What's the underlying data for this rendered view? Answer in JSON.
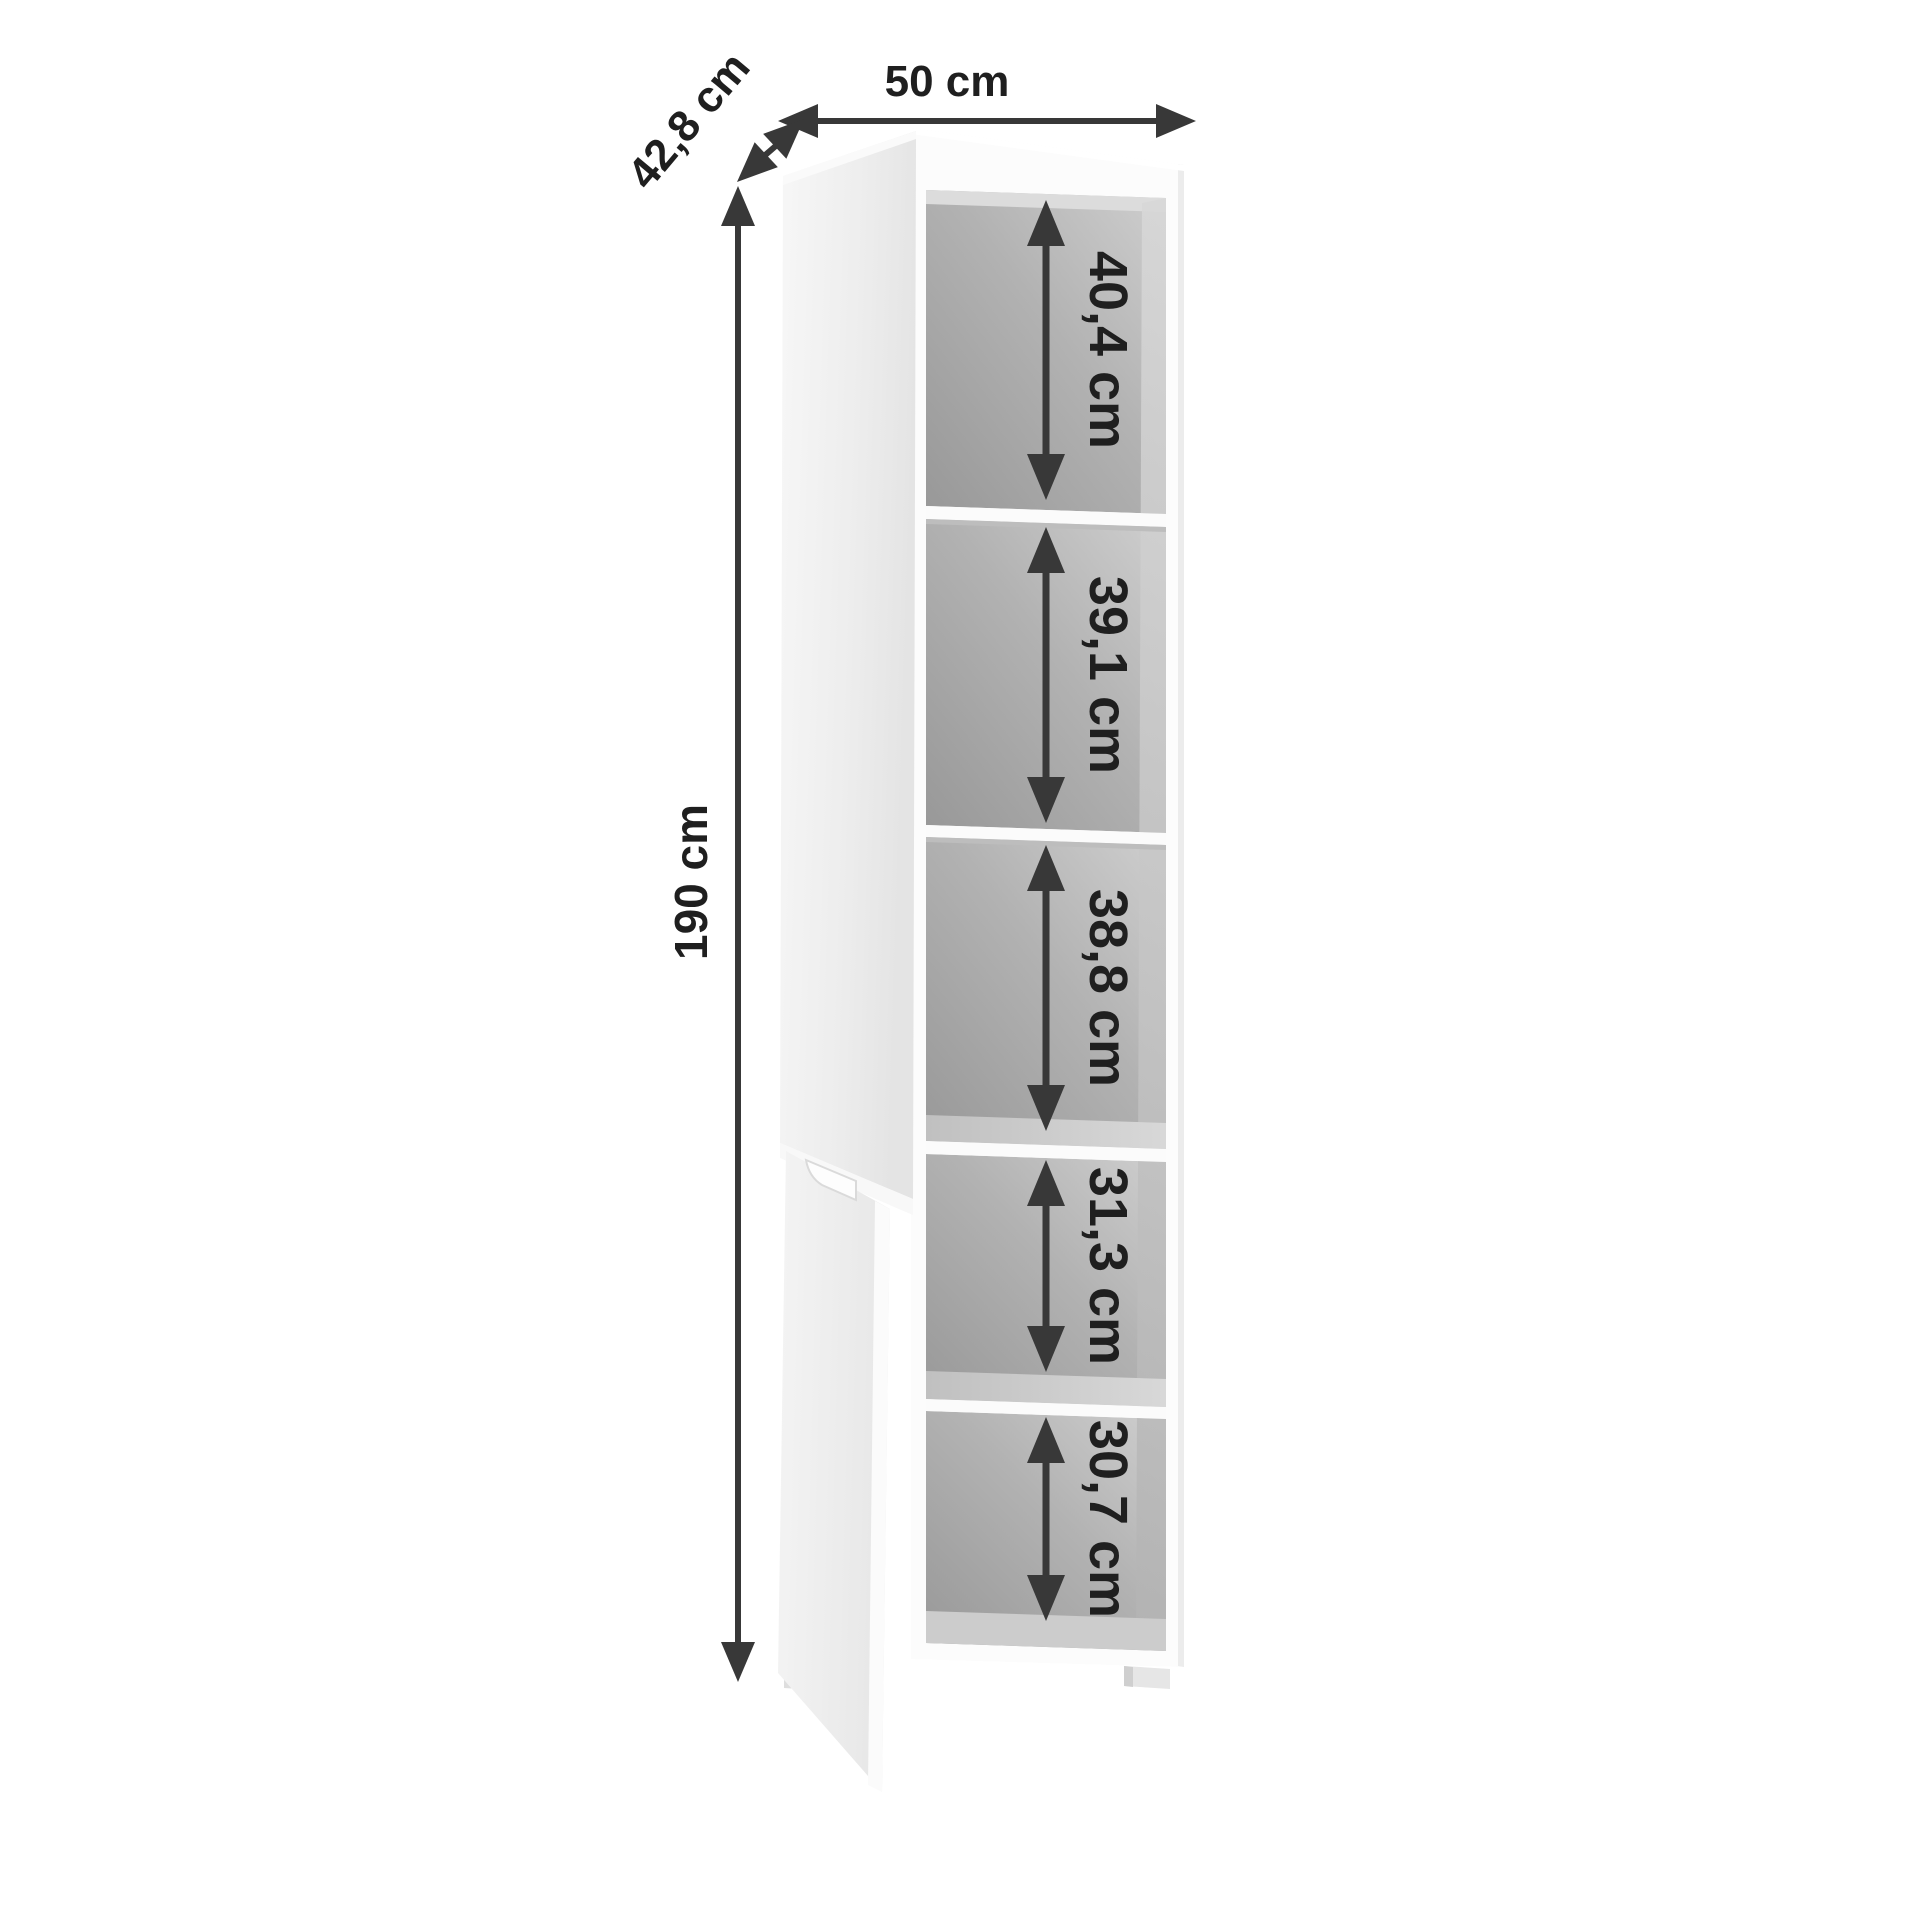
{
  "diagram": {
    "description": "Product dimension drawing of a tall narrow cabinet with two open doors and five shelf compartments",
    "dimensions": {
      "width": "50 cm",
      "depth": "42,8 cm",
      "height": "190 cm"
    },
    "compartments": [
      {
        "label": "40,4 cm"
      },
      {
        "label": "39,1 cm"
      },
      {
        "label": "38,8 cm"
      },
      {
        "label": "31,3 cm"
      },
      {
        "label": "30,7 cm"
      }
    ],
    "colors": {
      "annotation_arrow": "#383838",
      "annotation_text": "#1f1f1f",
      "carcass_white": "#fcfcfc",
      "interior_dark": "#989898",
      "interior_light": "#cfcfcf",
      "door_light": "#f7f7f7",
      "door_dark": "#e5e5e5",
      "background": "#ffffff"
    }
  }
}
